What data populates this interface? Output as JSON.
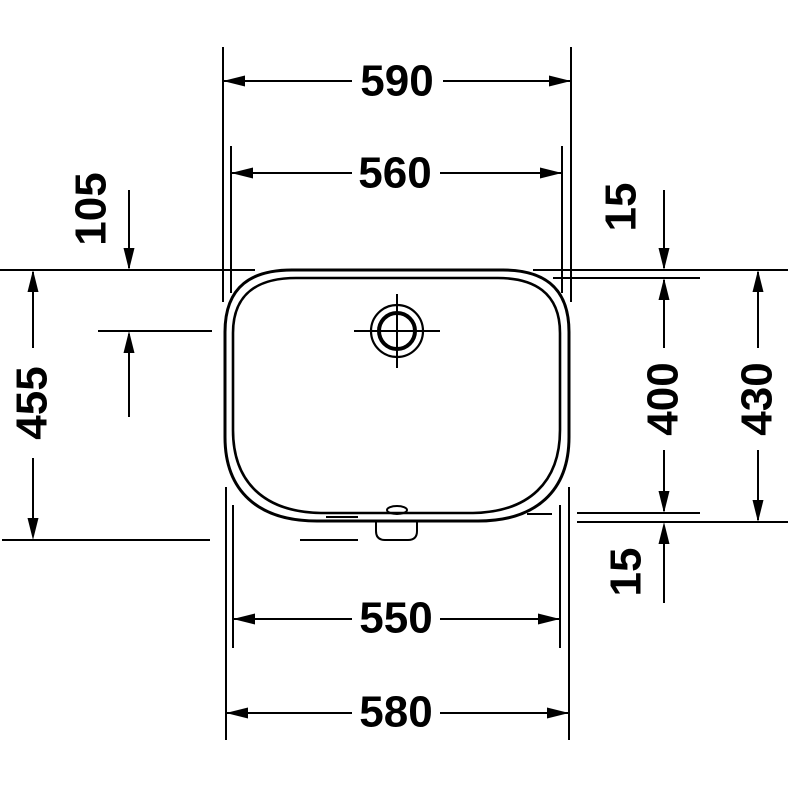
{
  "colors": {
    "ink": "#000000",
    "paper": "#ffffff"
  },
  "dims": {
    "top_outer": "590",
    "top_inner": "560",
    "tap_offset": "105",
    "overall_depth": "455",
    "rim_top": "15",
    "bowl_depth": "400",
    "outer_depth": "430",
    "rim_bottom": "15",
    "bottom_inner": "550",
    "bottom_outer": "580"
  }
}
